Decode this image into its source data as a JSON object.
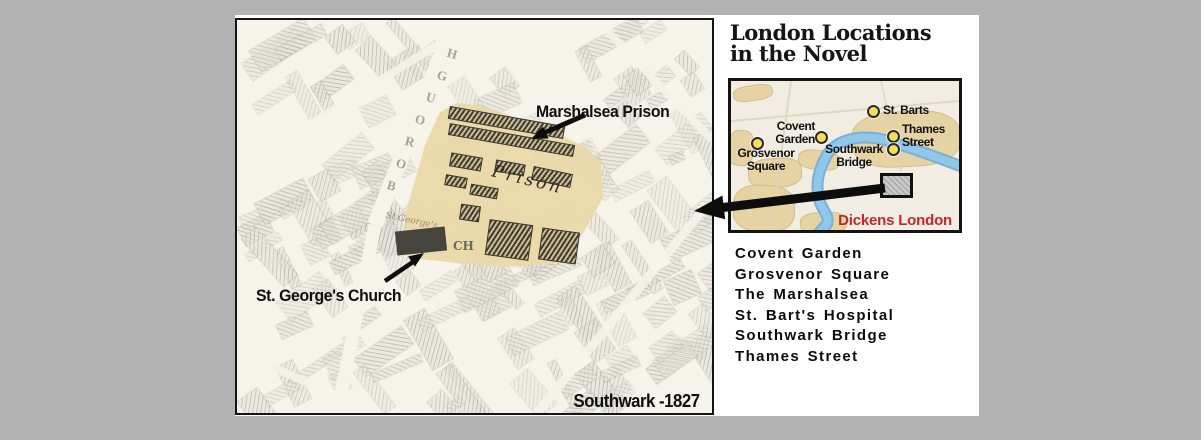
{
  "main_map": {
    "caption": "Southwark -1827",
    "street_name": "BOROUGH",
    "street_letters": [
      "B",
      "O",
      "R",
      "O",
      "U",
      "G",
      "H"
    ],
    "labels": {
      "prison": "Marshalsea Prison",
      "church": "St. George's Church"
    },
    "map_texts": {
      "prison_old": "Prison",
      "church_abbr": "CH",
      "church_small": "St George's"
    }
  },
  "panel": {
    "title_line1": "London Locations",
    "title_line2": "in the Novel",
    "inset": {
      "legend": "Dickens London",
      "markers": [
        {
          "label": "St. Barts"
        },
        {
          "line1": "Covent",
          "line2": "Garden"
        },
        {
          "line1": "Grosvenor",
          "line2": "Square"
        },
        {
          "line1": "Thames",
          "line2": "Street"
        },
        {
          "line1": "Southwark",
          "line2": "Bridge"
        }
      ]
    },
    "locations": [
      "Covent Garden",
      "Grosvenor Square",
      "The Marshalsea",
      "St. Bart's Hospital",
      "Southwark Bridge",
      "Thames Street"
    ]
  },
  "colors": {
    "background_gray": "#b2b2b2",
    "highlight_sepia": "#e9d8a9",
    "river_blue": "#8fc8eb",
    "marker_yellow": "#f6dd5b",
    "legend_red": "#c2262c"
  }
}
